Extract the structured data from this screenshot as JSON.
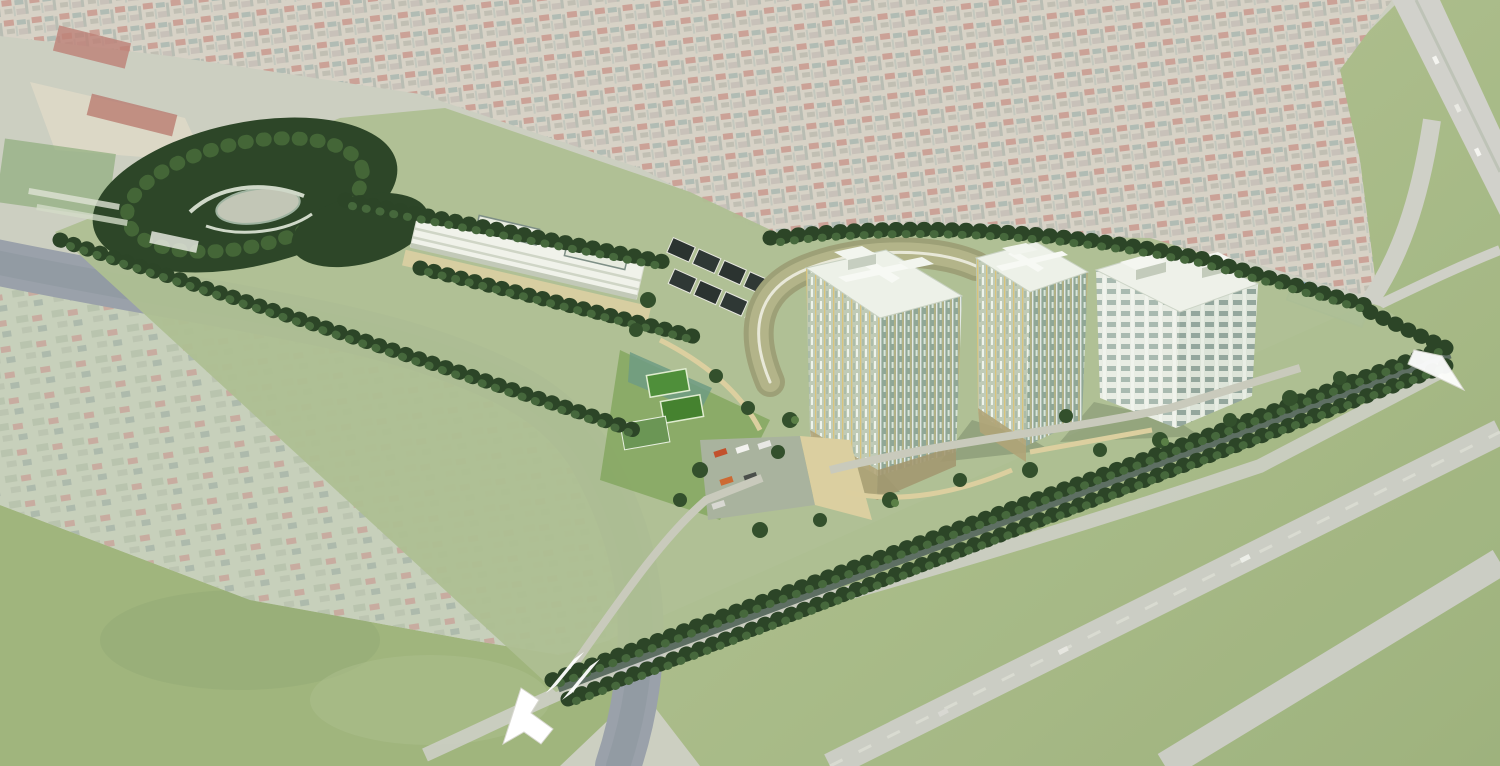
{
  "meta": {
    "type": "architectural-aerial-rendering",
    "description": "Bird's-eye photomontage of a residential master-plan development rendered over a faded aerial photo of a dense town, a winding river and open green fields"
  },
  "palette": {
    "urban_base": "#c6bfae",
    "roof_red": "#b5796a",
    "roof_teal": "#8f9f93",
    "river_grey": "#87909a",
    "field_green": "#97ad6f",
    "road_grey": "#c6c7bd",
    "tree_dark": "#2c4527",
    "tree_light": "#46683c",
    "site_ground": "#aebf92",
    "facade_sage": "#90a796",
    "facade_cream": "#c0cbb7",
    "accent_yellow": "#d9c47c",
    "roof_white": "#edf1e8",
    "path_beige": "#dccfa2",
    "townhouse_roof": "#2b3330",
    "pond_grey": "#c2c6b6",
    "court_teal": "#5d8f80",
    "pitch_green": "#4f8f3a",
    "shed_blue": "#8fb3c9",
    "arrow_white": "#ffffff"
  },
  "scene": {
    "labels": {
      "canvas": "aerial master-plan rendering",
      "urban": "existing dense urban fabric (faded aerial photo)",
      "topleft": "existing depot with red-roof sheds, yard and sports pitch",
      "village": "existing riverside village (faded aerial photo)",
      "river": "winding river",
      "field_sw": "open grass field (south-west)",
      "field_se": "open grass field (south-east)",
      "highway": "highway at top-right with median",
      "field_roads": "existing field roads",
      "riverside_road": "existing riverside road",
      "blue_shed": "existing blue-roof warehouse at east corner",
      "site": "proposed development site (saturated render)",
      "park": "wooded park with dense evergreen trees",
      "pond": "curved landscape pond with walking paths",
      "greenhouses": "existing greenhouse strips beside park",
      "school": "long low-rise school / community building with rooftop wings",
      "school_path": "beige promenade in front of school",
      "courts": "sports courts and mini football pitch",
      "townhouses": "two rows of dark-roof townhouses",
      "podium": "curved podium building with olive roof",
      "tower_a": "high-rise apartment tower A (sage facade, yellow accents)",
      "tower_b": "high-rise apartment tower B (sage facade, yellow accents)",
      "slab": "white slab apartment building with rooftop boxes",
      "parking": "surface parking lot with cars and beige plaza",
      "boulevard": "tree-lined boundary boulevard",
      "tree_belts": "tree belts along site boundaries",
      "tree_scatter": "landscape trees between buildings",
      "walkways": "beige landscape walkways",
      "arrow_sw": "white entrance arrow at south-west gateway",
      "arrow_e": "white entrance arrow at east gateway",
      "crosswalk": "white gateway stripes",
      "cars": "cars on roads"
    }
  }
}
